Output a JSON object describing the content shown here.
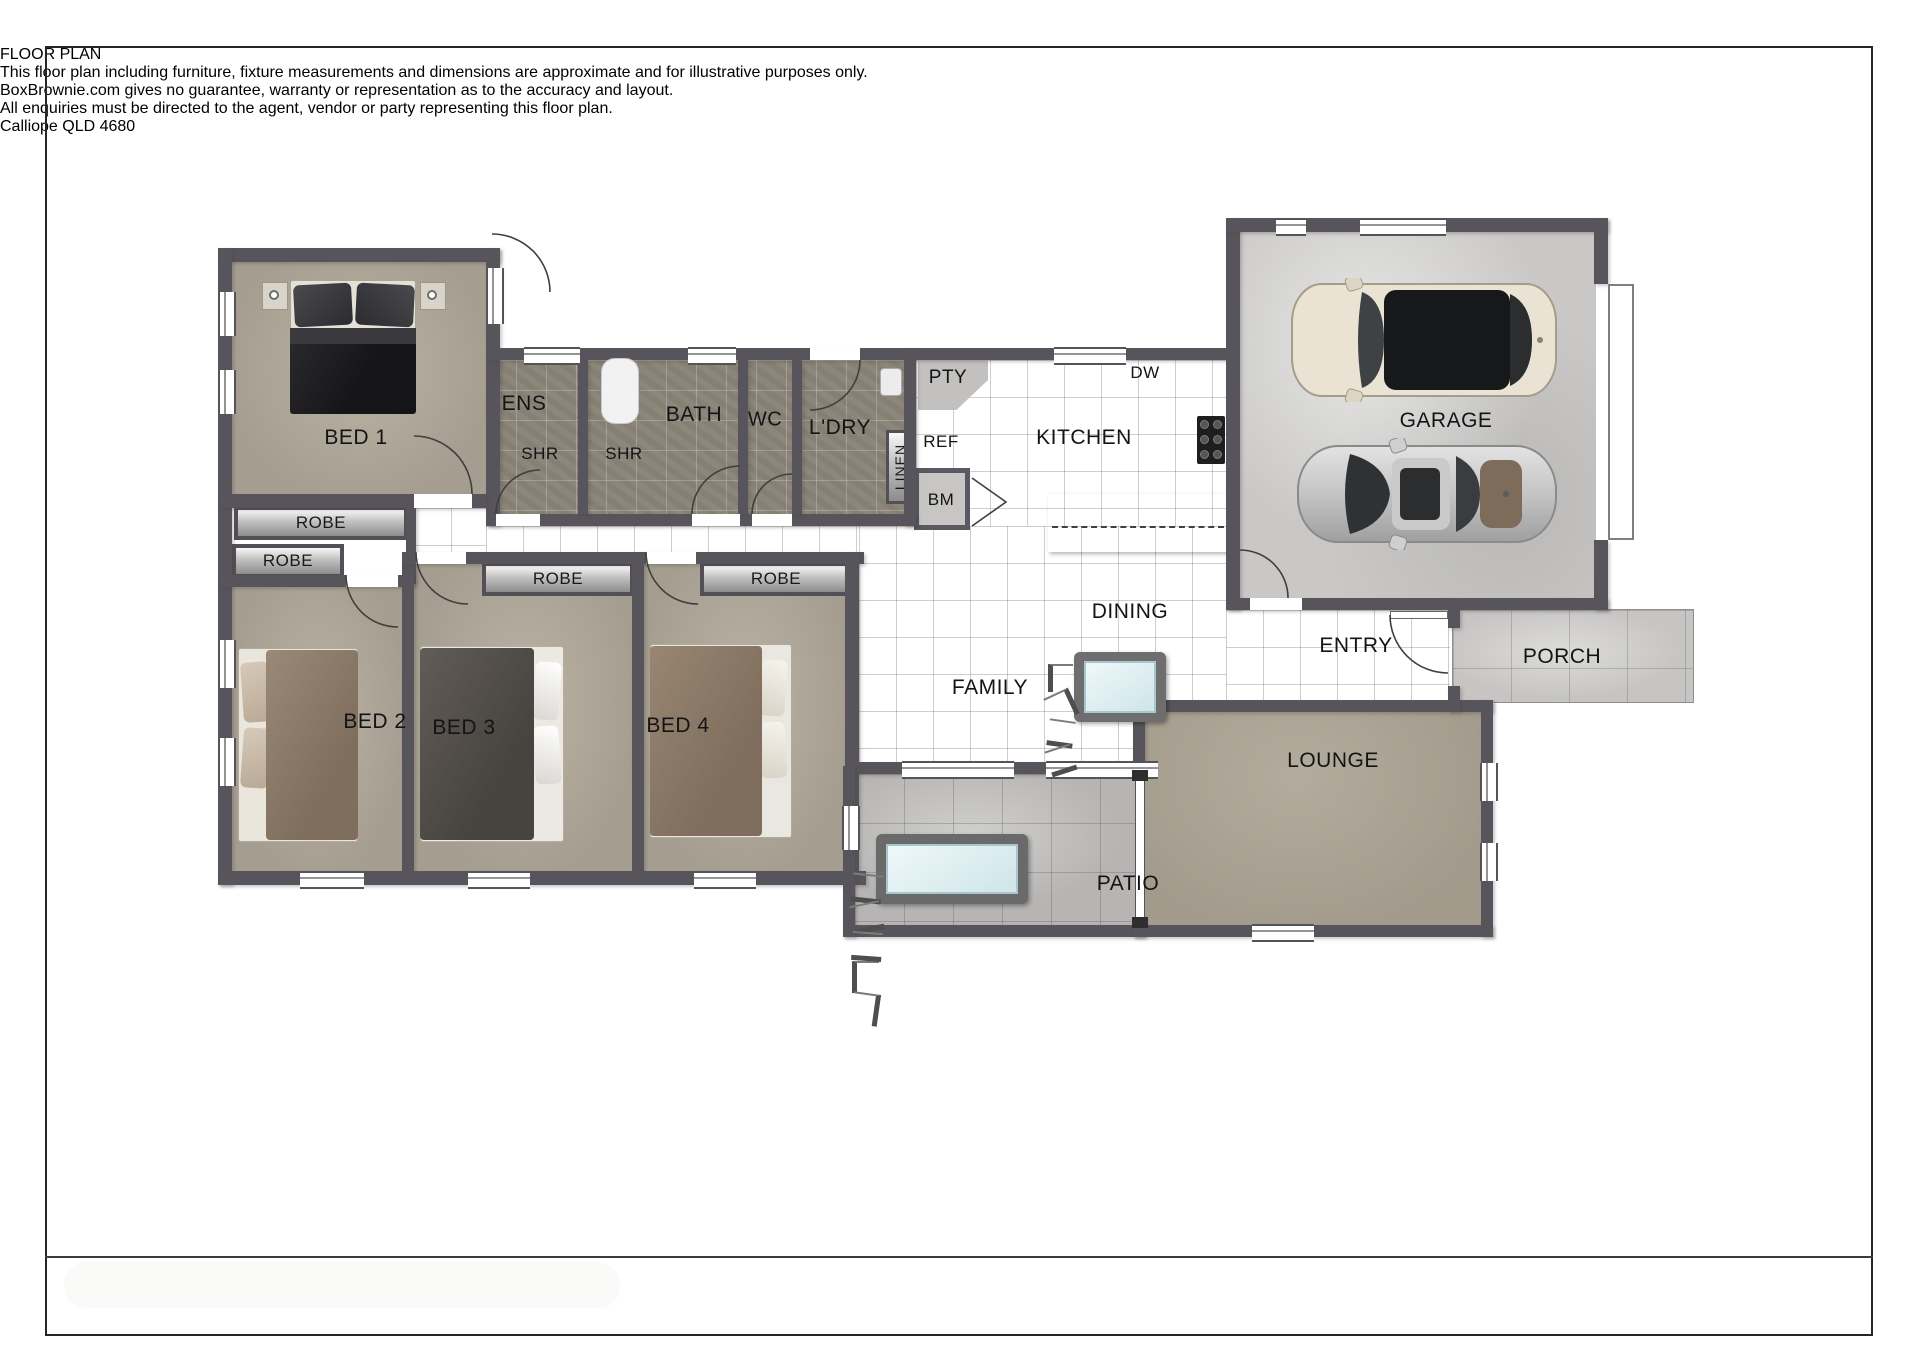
{
  "page": {
    "title": "FLOOR PLAN",
    "address": "Calliope QLD 4680",
    "disclaimer_line1": "This floor plan including furniture, fixture measurements and dimensions are approximate and for illustrative purposes only.",
    "disclaimer_line2": "BoxBrownie.com gives no guarantee, warranty or representation as to the accuracy and layout.",
    "disclaimer_line3": "All enquiries must be directed to the agent, vendor or party representing this floor plan."
  },
  "rooms": {
    "bed1": "BED 1",
    "bed2": "BED 2",
    "bed3": "BED 3",
    "bed4": "BED 4",
    "ens": "ENS",
    "shr": "SHR",
    "bath": "BATH",
    "wc": "WC",
    "ldry": "L'DRY",
    "pty": "PTY",
    "ref": "REF",
    "linen": "LINEN",
    "bm": "BM",
    "dw": "DW",
    "kitchen": "KITCHEN",
    "garage": "GARAGE",
    "robe": "ROBE",
    "family": "FAMILY",
    "dining": "DINING",
    "entry": "ENTRY",
    "porch": "PORCH",
    "lounge": "LOUNGE",
    "patio": "PATIO"
  },
  "colors": {
    "wall": "#57555b",
    "carpet": "#a9a294",
    "bath_tile": "#8d867a",
    "garage_concrete": "#c9c8c6",
    "patio_concrete": "#b6b5b3",
    "glass_blue": "#e2f1f3",
    "sofa_beige": "#e0cbaa",
    "car_cream": "#eae3d3",
    "car_silver": "#c9c9c9"
  }
}
